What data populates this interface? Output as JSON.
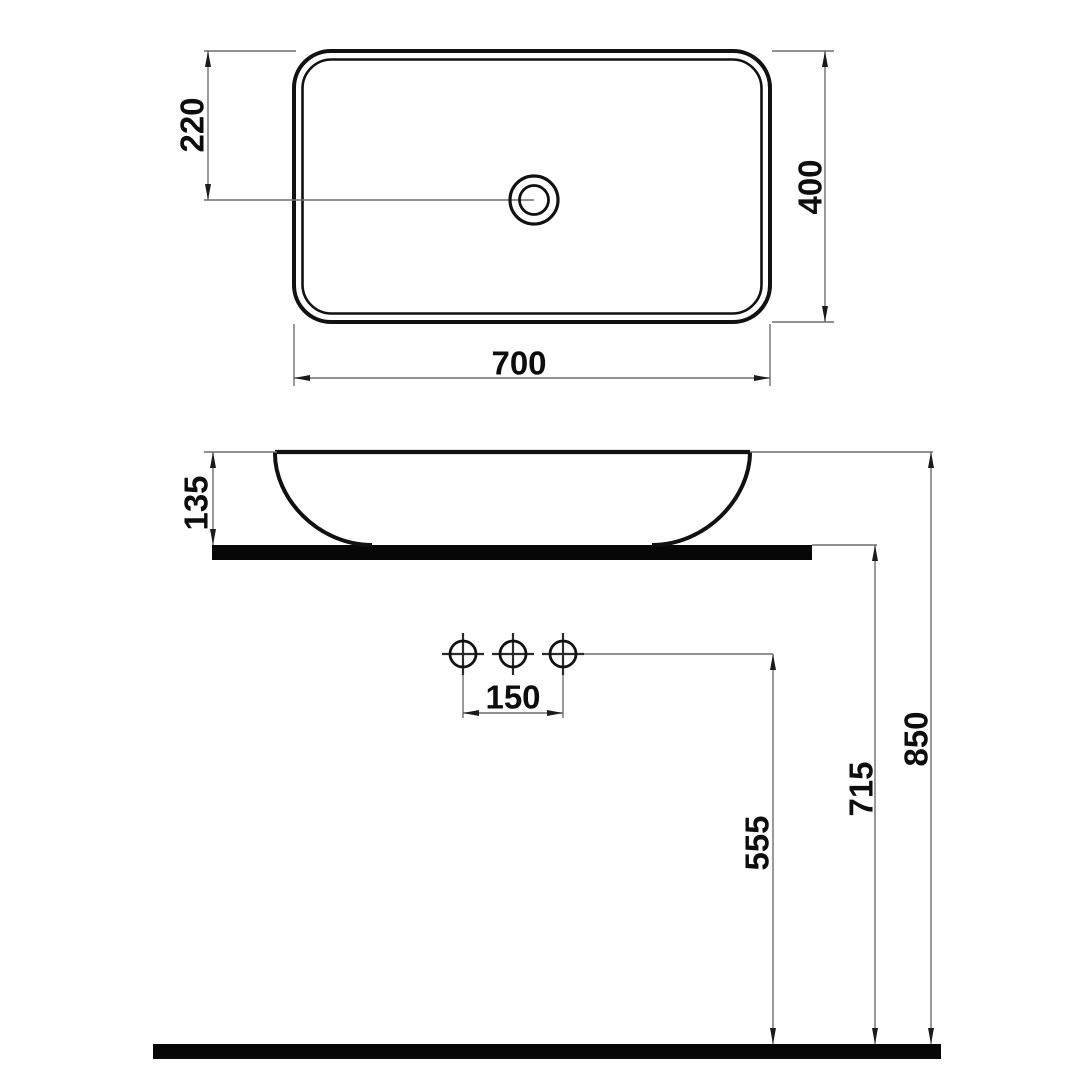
{
  "page": {
    "background": "#ffffff",
    "kind": "sanitaryware technical dimension drawing",
    "units": "mm"
  },
  "colors": {
    "object_line": "#111111",
    "dimension_line": "#6f6f6f",
    "solid_fill": "#070707",
    "label_text": "#0d0d0d"
  },
  "drawing": {
    "views": {
      "top_view": {
        "description": "plan view of rectangular countertop basin with drain",
        "basin_length_mm": 700,
        "basin_depth_mm": 400,
        "drain_offset_mm": 220
      },
      "front_view": {
        "description": "front elevation on countertop with faucet holes and floor",
        "basin_height_mm": 135,
        "faucet_hole_count": 3,
        "faucet_hole_spacing_mm": 150,
        "holes_height_above_floor_mm": 555,
        "countertop_height_above_floor_mm": 715,
        "rim_height_above_floor_mm": 850
      }
    },
    "dims": {
      "drain_offset": {
        "label": "220",
        "value": 220,
        "orientation": "vertical"
      },
      "basin_depth": {
        "label": "400",
        "value": 400,
        "orientation": "vertical"
      },
      "basin_length": {
        "label": "700",
        "value": 700,
        "orientation": "horizontal"
      },
      "basin_height": {
        "label": "135",
        "value": 135,
        "orientation": "vertical"
      },
      "hole_spacing": {
        "label": "150",
        "value": 150,
        "orientation": "horizontal"
      },
      "holes_height": {
        "label": "555",
        "value": 555,
        "orientation": "vertical"
      },
      "counter_height": {
        "label": "715",
        "value": 715,
        "orientation": "vertical"
      },
      "rim_height": {
        "label": "850",
        "value": 850,
        "orientation": "vertical"
      }
    }
  }
}
